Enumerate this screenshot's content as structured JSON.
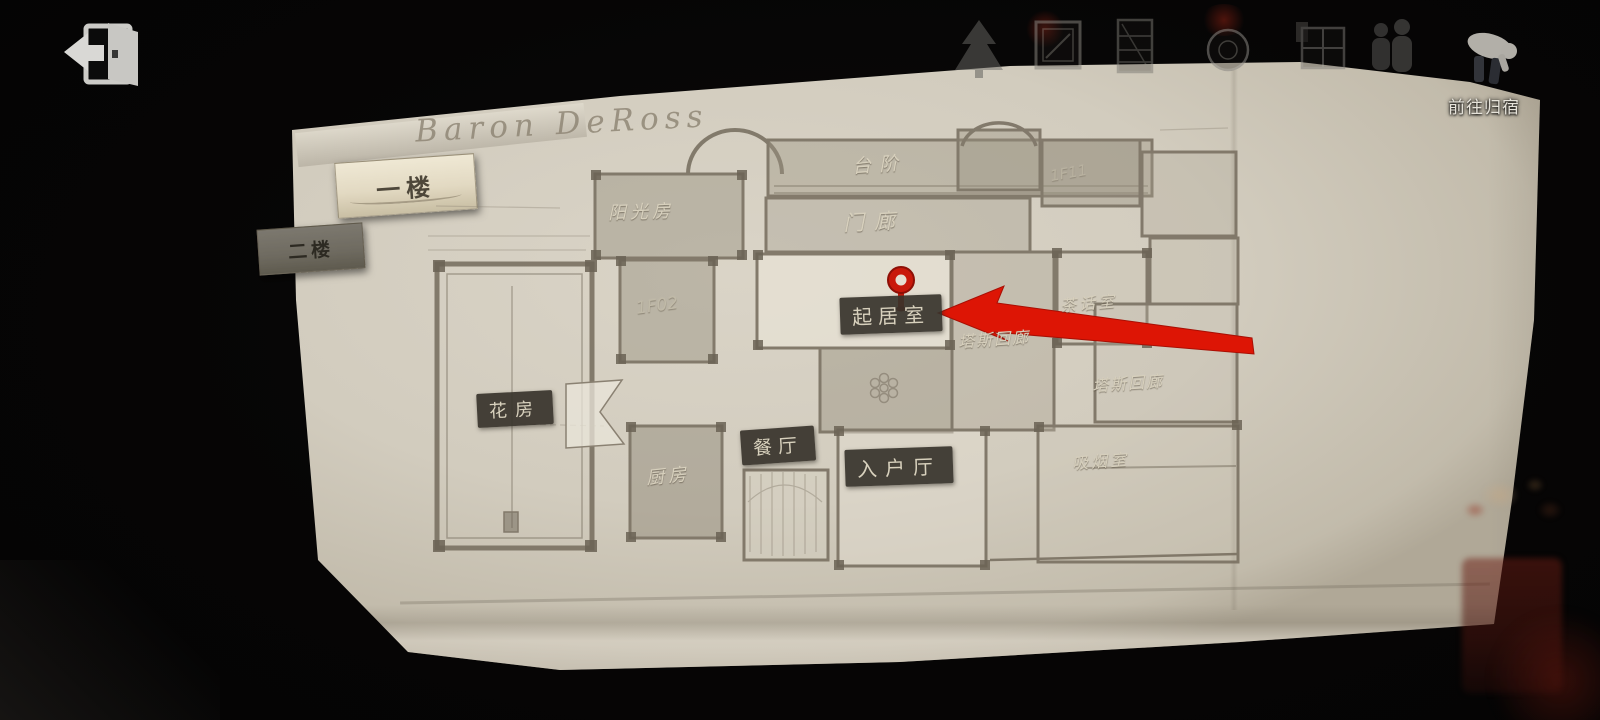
{
  "topbar": {
    "back_icon": "door-exit-arrow",
    "icons": [
      "tree",
      "painting",
      "cabinet",
      "plate",
      "window",
      "figures",
      "person-carrying"
    ],
    "go_home_label": "前往归宿"
  },
  "map": {
    "title": "Baron DeRoss",
    "floor_tabs": [
      {
        "label": "一楼",
        "active": true
      },
      {
        "label": "二楼",
        "active": false
      }
    ],
    "marker": {
      "type": "location-pin",
      "room": "起居室",
      "pointer": "red-arrow"
    },
    "rooms": [
      {
        "label": "台阶",
        "style": "plain"
      },
      {
        "label": "门廊",
        "style": "plain"
      },
      {
        "label": "阳光房",
        "style": "plain"
      },
      {
        "label": "1F11",
        "style": "faint"
      },
      {
        "label": "1F02",
        "style": "faint"
      },
      {
        "label": "起居室",
        "style": "badge"
      },
      {
        "label": "茶话室",
        "style": "plain"
      },
      {
        "label": "塔斯回廊",
        "style": "plain"
      },
      {
        "label": "塔斯回廊",
        "style": "plain"
      },
      {
        "label": "花房",
        "style": "badge"
      },
      {
        "label": "餐厅",
        "style": "badge"
      },
      {
        "label": "厨房",
        "style": "plain"
      },
      {
        "label": "入户厅",
        "style": "badge"
      },
      {
        "label": "吸烟室",
        "style": "plain"
      }
    ],
    "colors": {
      "paper": "#d2ccbe",
      "wall": "#7a7162",
      "room_fill": "#a39b8b",
      "badge_bg": "#37332b",
      "badge_text": "#d8d1bd",
      "accent_red": "#d81708"
    }
  }
}
